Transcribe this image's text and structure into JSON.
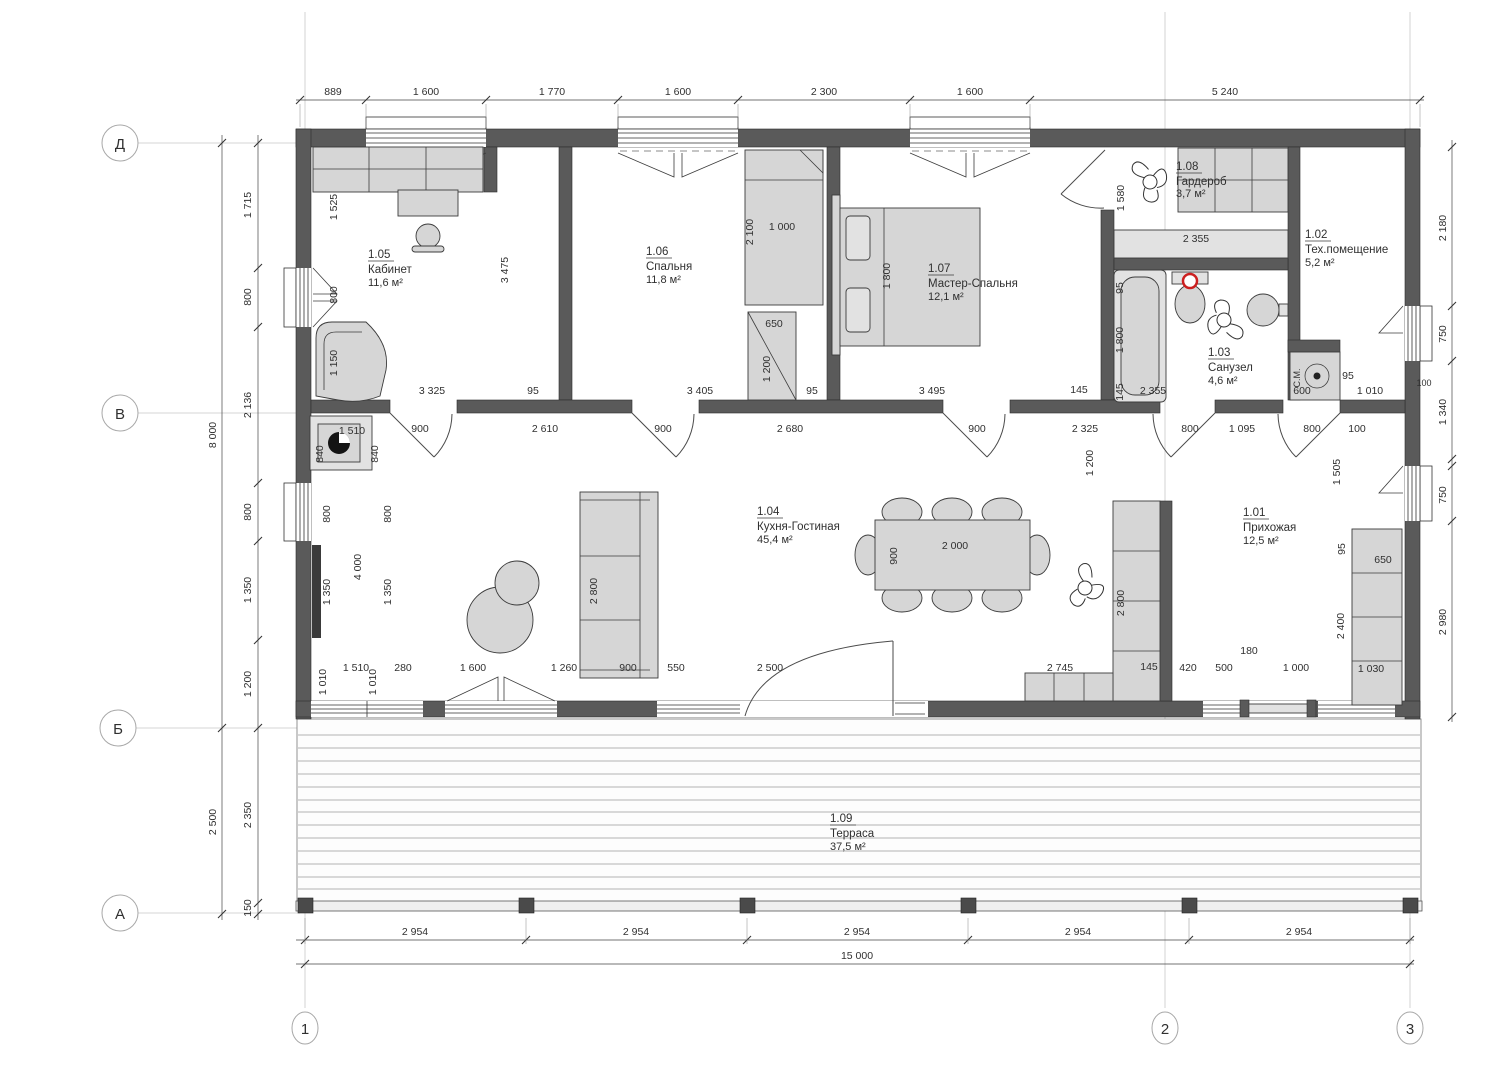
{
  "title": "Floor plan",
  "grid": {
    "rows": [
      "Д",
      "В",
      "Б",
      "А"
    ],
    "cols": [
      "1",
      "2",
      "3"
    ]
  },
  "rooms": [
    {
      "num": "1.01",
      "name": "Прихожая",
      "area": "12,5 м²"
    },
    {
      "num": "1.02",
      "name": "Тех.помещение",
      "area": "5,2 м²"
    },
    {
      "num": "1.03",
      "name": "Санузел",
      "area": "4,6 м²"
    },
    {
      "num": "1.04",
      "name": "Кухня-Гостиная",
      "area": "45,4 м²"
    },
    {
      "num": "1.05",
      "name": "Кабинет",
      "area": "11,6 м²"
    },
    {
      "num": "1.06",
      "name": "Спальня",
      "area": "11,8 м²"
    },
    {
      "num": "1.07",
      "name": "Мастер-Спальня",
      "area": "12,1 м²"
    },
    {
      "num": "1.08",
      "name": "Гардероб",
      "area": "3,7 м²"
    },
    {
      "num": "1.09",
      "name": "Терраса",
      "area": "37,5 м²"
    }
  ],
  "dim": {
    "top": [
      "889",
      "1 600",
      "1 770",
      "1 600",
      "2 300",
      "1 600",
      "5 240"
    ],
    "bottom": [
      "2 954",
      "2 954",
      "2 954",
      "2 954",
      "2 954"
    ],
    "bottom_total": "15 000",
    "left": [
      "1 715",
      "800",
      "2 136",
      "800",
      "1 350",
      "1 200",
      "2 350",
      "150"
    ],
    "left_outer": [
      "8 000",
      "2 500"
    ],
    "right": [
      "2 180",
      "750",
      "1 340",
      "100",
      "750",
      "2 980"
    ],
    "inner": [
      "1 525",
      "800",
      "1 150",
      "3 475",
      "3 325",
      "95",
      "3 405",
      "95",
      "2 100",
      "1 000",
      "650",
      "1 200",
      "1 800",
      "3 495",
      "145",
      "1 580",
      "2 355",
      "95",
      "1 800",
      "145",
      "2 355",
      "600",
      "95",
      "1 010",
      "900",
      "2 610",
      "900",
      "2 680",
      "900",
      "2 325",
      "800",
      "1 095",
      "800",
      "100",
      "840",
      "1 510",
      "840",
      "800",
      "800",
      "4 000",
      "1 350",
      "1 350",
      "1 010",
      "1 510",
      "1 010",
      "280",
      "1 600",
      "1 260",
      "900",
      "550",
      "2 500",
      "2 800",
      "900",
      "2 000",
      "1 200",
      "2 800",
      "2 745",
      "145",
      "420",
      "500",
      "180",
      "1 000",
      "1 030",
      "1 505",
      "95",
      "650",
      "2 400",
      "100"
    ]
  },
  "labels": {
    "sm": "С.М."
  },
  "colors": {
    "wall": "#5a5a5a",
    "furniture": "#d6d6d6",
    "accent_red": "#cc2020"
  }
}
